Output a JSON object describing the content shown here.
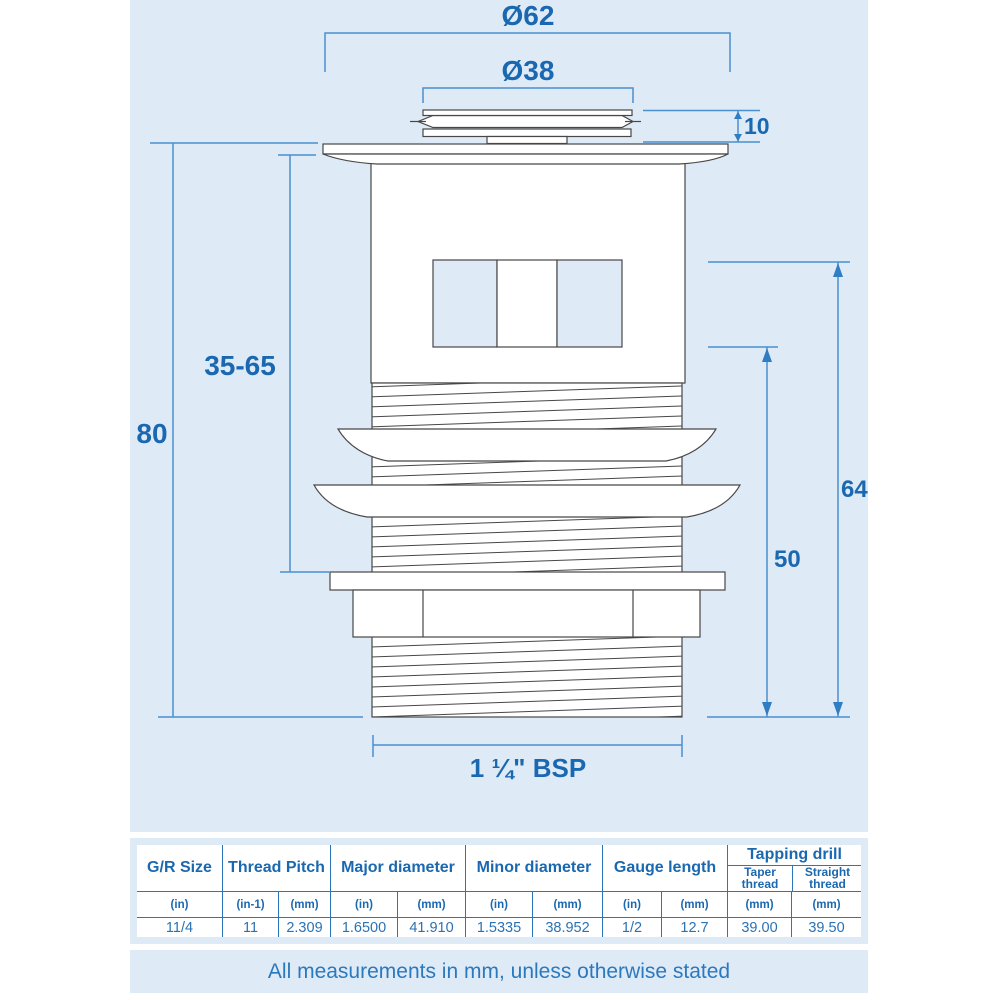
{
  "diagram": {
    "labels": {
      "outer_diameter": "Ø62",
      "inner_diameter": "Ø38",
      "cap_height": "10",
      "clamp_range": "35-65",
      "overall_height": "80",
      "slot_top_depth": "64",
      "slot_bottom_depth": "50",
      "thread_size": "1 ¼\" BSP"
    }
  },
  "table": {
    "headers": [
      "G/R Size",
      "Thread Pitch",
      "Major diameter",
      "Minor diameter",
      "Gauge length",
      "Tapping drill"
    ],
    "tapping_subheaders": [
      "Taper thread",
      "Straight thread"
    ],
    "units": [
      "(in)",
      "(in-1)",
      "(mm)",
      "(in)",
      "(mm)",
      "(in)",
      "(mm)",
      "(in)",
      "(mm)",
      "(mm)",
      "(mm)"
    ],
    "values": [
      "11/4",
      "11",
      "2.309",
      "1.6500",
      "41.910",
      "1.5335",
      "38.952",
      "1/2",
      "12.7",
      "39.00",
      "39.50"
    ]
  },
  "note": {
    "text": "All measurements in mm, unless otherwise stated"
  },
  "colors": {
    "panel_bg": "#dfeaf7",
    "dimension_line_blue": "#4a90cf",
    "label_text_blue": "#1a68b0",
    "table_line_blue": "#2b76b9",
    "drawing_outline": "#474747"
  }
}
